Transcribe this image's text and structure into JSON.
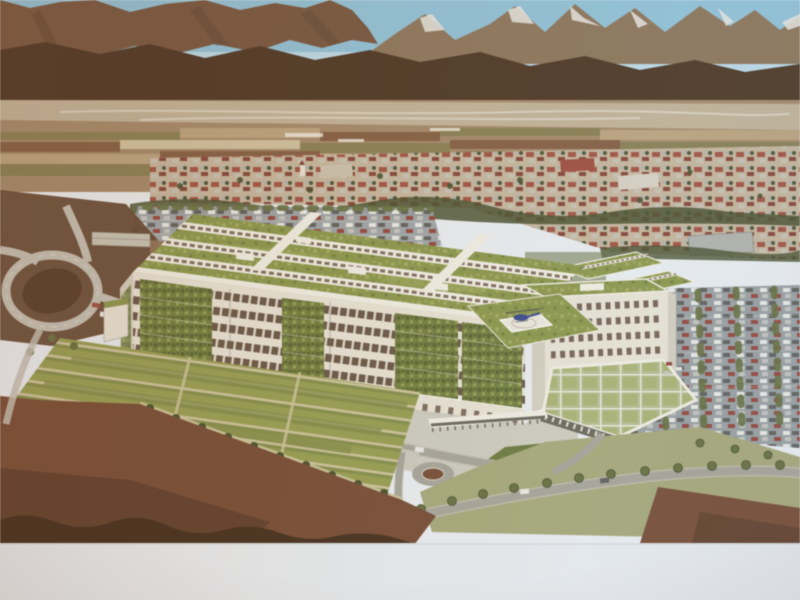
{
  "scene": {
    "type": "photograph of a projection screen / presentation slide",
    "description": "Aerial architectural rendering of a new hospital complex: long white slab building with vertical-garden facade panels, extensive green sedum roofs with white penthouse wings, rooftop helipad with blue helicopter, entrance canopy, large visitor parking lot, striped therapeutic garden plots, highway interchange, surrounded by a town with red roofs, patchwork valley farmland and snow-capped mountains under a blue sky; white slide margin along the bottom edge"
  },
  "palette": {
    "sky": "#90c4db",
    "skyLow": "#bcdcea",
    "mountain": "#7c5a41",
    "mountainLight": "#91795c",
    "ridgeShadow": "#5f4430",
    "foothill": "#523b28",
    "snow": "#eae8e1",
    "valley": "#a98c6a",
    "riverbed": "#c7b99e",
    "fieldTan": "#bfa67e",
    "fieldOlive": "#8d8254",
    "fieldBrown": "#8a6244",
    "fieldPale": "#d3c39e",
    "townBase": "#c8b89e",
    "roofRed": "#a65140",
    "roofDark": "#8a4335",
    "bigRoofGray": "#b4b5af",
    "shedWall": "#c9c5b5",
    "buildingWhite": "#eae5d6",
    "buildingShade": "#d6d1c0",
    "parapet": "#f3f0e4",
    "windowDark": "#6e5a49",
    "mullion": "#ddd8c6",
    "greenWall": "#75823f",
    "greenWallDark": "#5c6a31",
    "greenWallLight": "#93a252",
    "greenRoof": "#8d9a4a",
    "greenRoofLight": "#a3ae5d",
    "greenRoofDark": "#76843e",
    "canopyGreen": "#b6bf8c",
    "canopyShadow": "#6e6c5e",
    "treeGreen": "#6a7340",
    "treeDark": "#4c5530",
    "asphalt": "#9ba3a5",
    "roadLight": "#c6c1b4",
    "roadMid": "#a9a79b",
    "concrete": "#cfccbe",
    "helipadWhite": "#edeadd",
    "heliBlue": "#3d4e92",
    "rotorGray": "#5a5a55",
    "skidGray": "#8a8a84",
    "lawn": "#a9ab79",
    "lawnDark": "#6f7d3f",
    "plotGreen": "#9aa150",
    "plotGreen2": "#87924a",
    "plotPale": "#cfc69b",
    "soil": "#7c5036",
    "soilDark": "#5d3c2a",
    "silhouette": "#47311f",
    "embankment": "#6a4c34",
    "island": "#5d3f2c",
    "groundLeft": "#97795a",
    "border": "#e9edf0",
    "borderLine": "#d6dbde",
    "carWhite": "#ebebe4",
    "carDark": "#64645f",
    "carRed": "#9c4a3e",
    "carSilver": "#c6c6c0",
    "postWhite": "#efece0"
  }
}
